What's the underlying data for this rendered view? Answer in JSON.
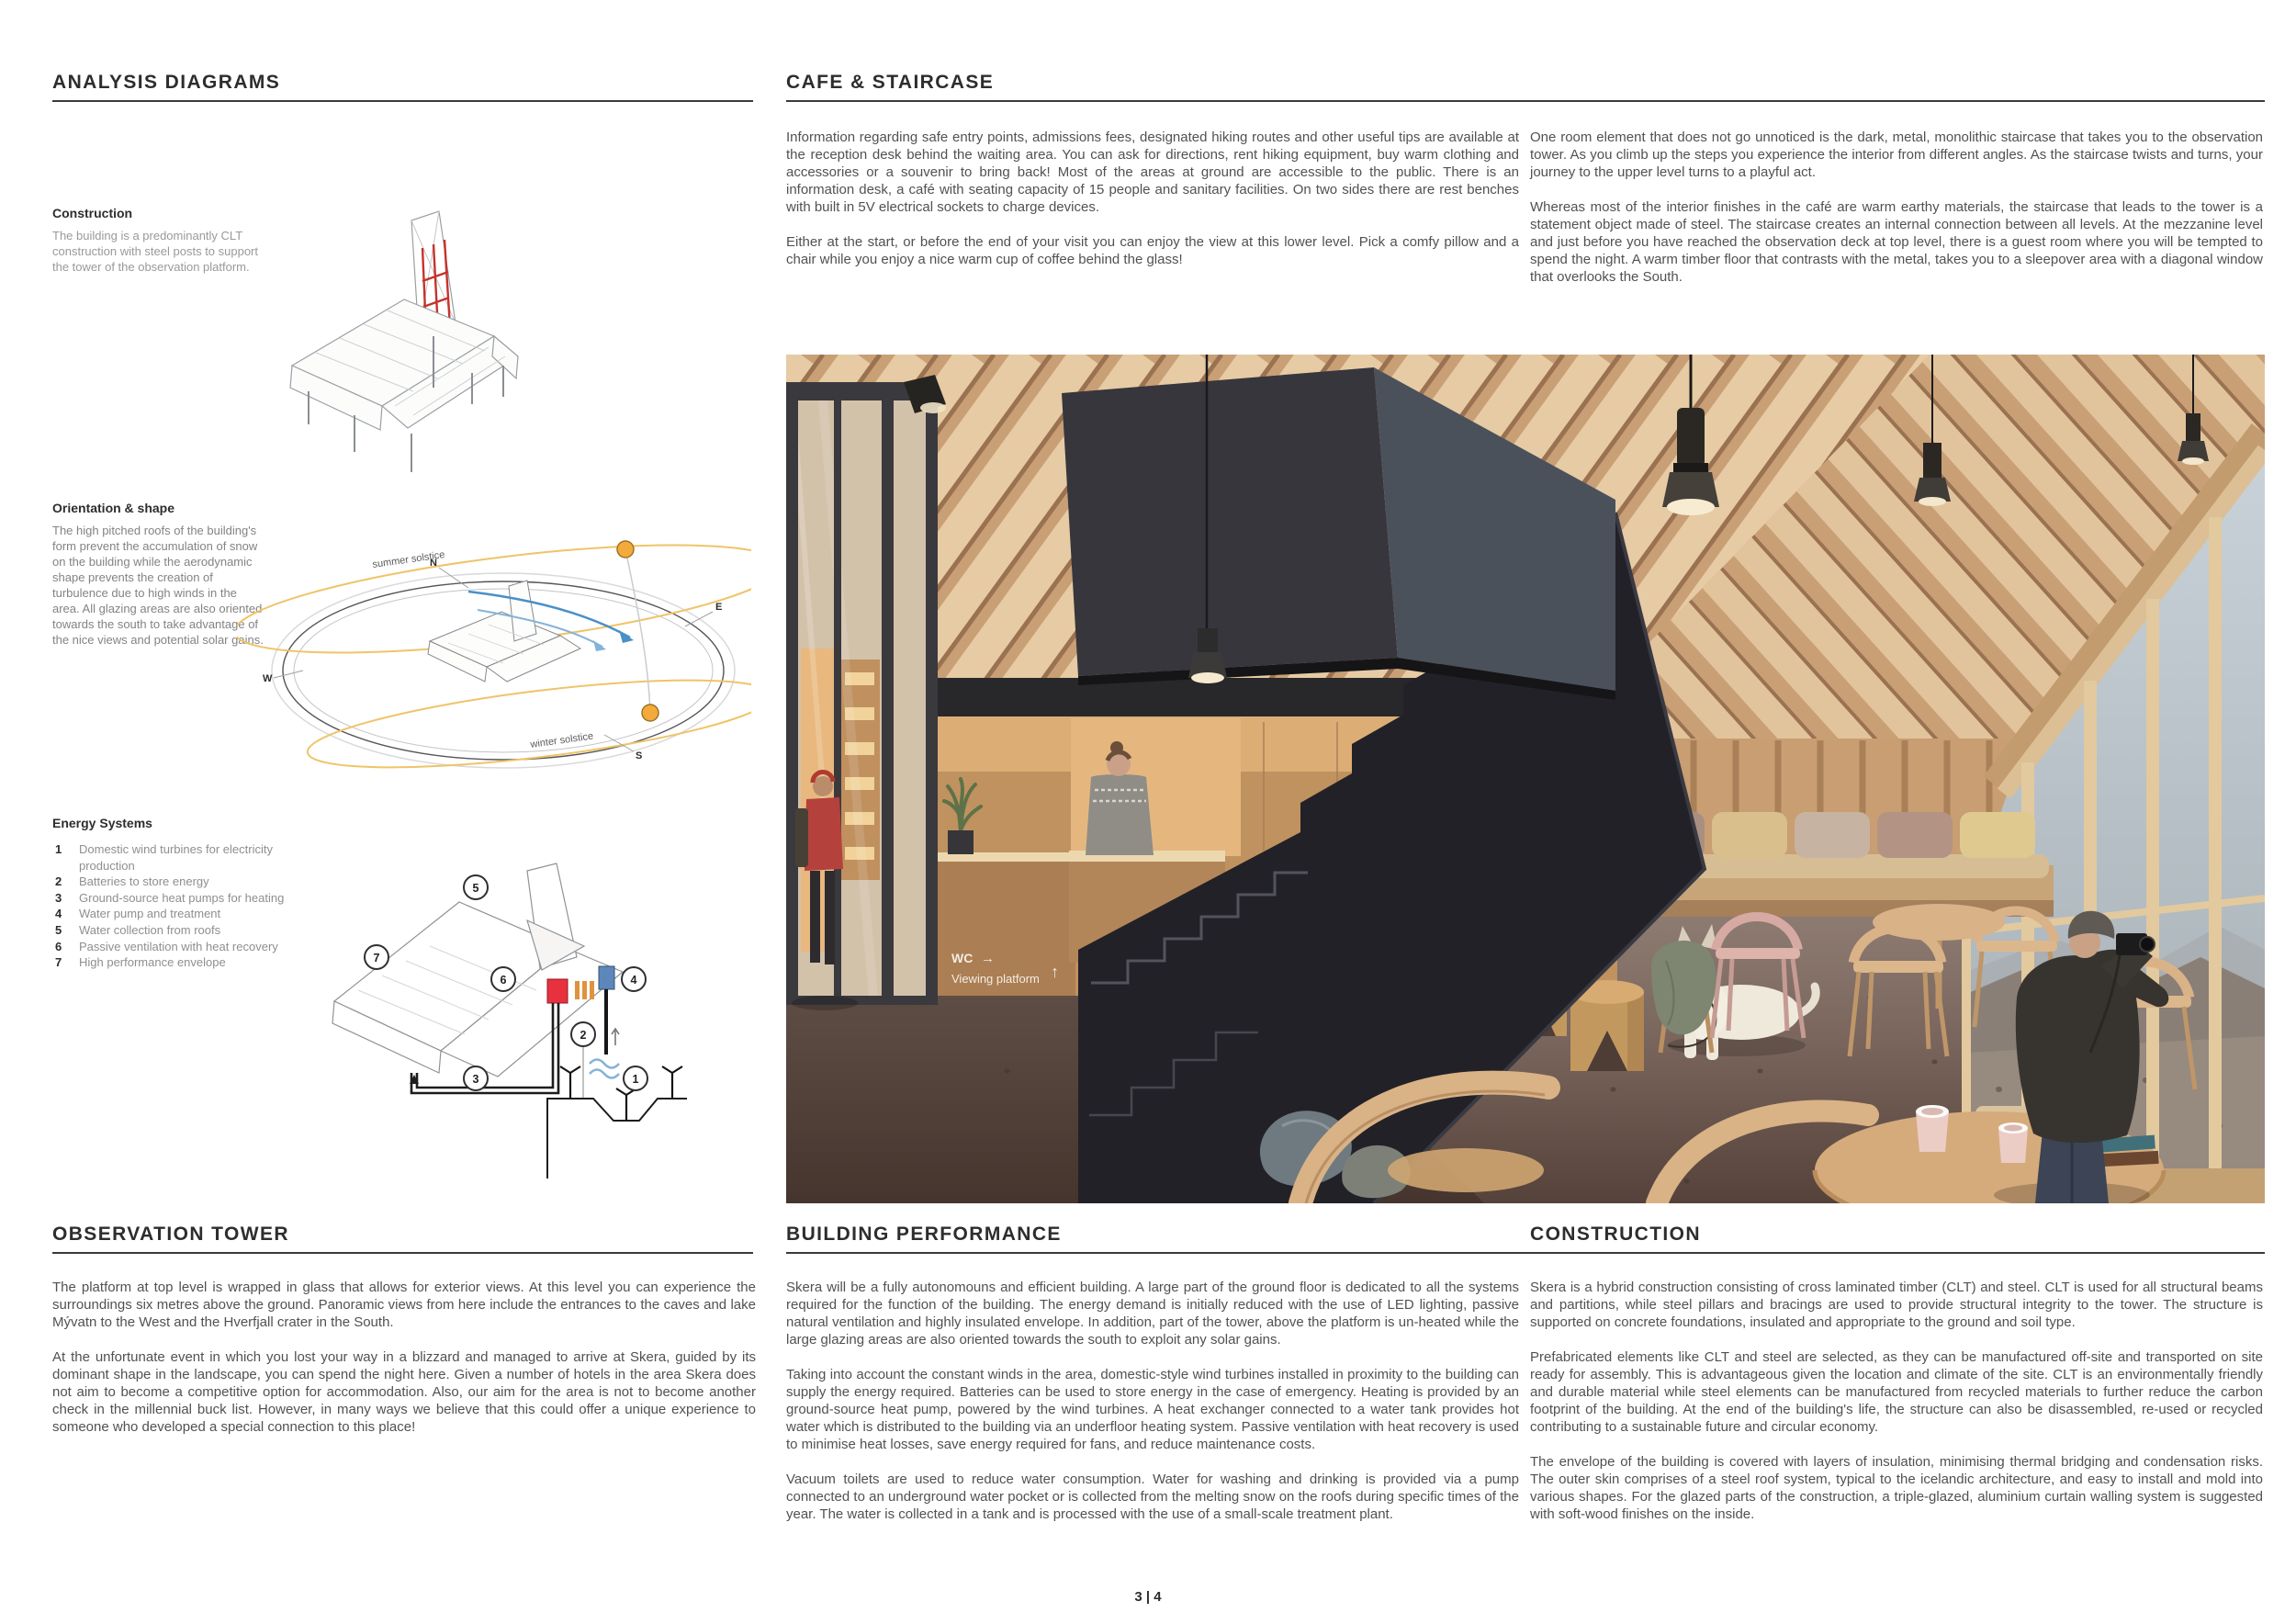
{
  "analysis": {
    "title": "ANALYSIS DIAGRAMS",
    "construction": {
      "heading": "Construction",
      "body": "The building is a predominantly CLT construction with steel posts to support the tower of the observation platform."
    },
    "orientation": {
      "heading": "Orientation & shape",
      "body": "The high pitched roofs of the building's form prevent the accumulation of snow on the building while the aerodynamic shape prevents the creation of turbulence due to high winds in the area. All glazing areas are also oriented towards the south to take advantage of the nice views and potential solar gains.",
      "labels": {
        "north": "N",
        "east": "E",
        "south": "S",
        "west": "W",
        "summer": "summer solstice",
        "winter": "winter solstice"
      }
    },
    "energy": {
      "heading": "Energy Systems",
      "items": [
        {
          "num": "1",
          "label": "Domestic wind turbines for electricity production"
        },
        {
          "num": "2",
          "label": "Batteries to store energy"
        },
        {
          "num": "3",
          "label": "Ground-source heat pumps for heating"
        },
        {
          "num": "4",
          "label": "Water pump and treatment"
        },
        {
          "num": "5",
          "label": "Water collection from roofs"
        },
        {
          "num": "6",
          "label": "Passive ventilation with heat recovery"
        },
        {
          "num": "7",
          "label": "High performance envelope"
        }
      ]
    }
  },
  "cafe": {
    "title": "CAFE & STAIRCASE",
    "col1": [
      "Information regarding safe entry points, admissions fees, designated hiking routes and other useful tips are available at the reception desk behind the waiting area. You can ask for directions, rent hiking equipment, buy warm clothing and accessories or a souvenir to bring back! Most of the areas at ground are accessible to the public. There is an information desk, a café with seating capacity of 15 people and sanitary facilities. On two sides there are rest benches with built in 5V electrical sockets to charge devices.",
      "Either at the start, or before the end of your visit you can enjoy the view at this lower level. Pick a comfy pillow and a chair while you enjoy a nice warm cup of coffee behind the glass!"
    ],
    "col2": [
      "One room element that does not go unnoticed is the dark, metal, monolithic staircase that takes you to the observation tower. As you climb up the steps you experience the interior from different angles. As the staircase twists and turns, your journey to the upper level turns to a playful act.",
      "Whereas most of the interior finishes in the café are warm earthy materials, the staircase that leads to the tower is a statement object made of steel. The staircase creates an internal connection between all levels. At the mezzanine level and just before you have reached the observation deck at top level, there is a guest room where you will be tempted to spend the night. A warm timber floor that contrasts with the metal, takes you to a sleepover area with a diagonal window that overlooks the South."
    ],
    "render": {
      "wc": "WC",
      "wc_arrow": "→",
      "viewing": "Viewing platform",
      "up_arrow": "↑"
    }
  },
  "observation": {
    "title": "OBSERVATION TOWER",
    "paragraphs": [
      "The platform at top level is wrapped in glass that allows for exterior views. At this level you can experience the surroundings six metres above the ground. Panoramic views from here include the entrances to the caves and lake Mývatn to the West and the Hverfjall crater in the South.",
      "At the unfortunate event in which you lost your way in a blizzard and managed to arrive at Skera, guided by its dominant shape in the landscape, you can spend the night here. Given a number of hotels in the area Skera does not aim to become a competitive option for accommodation. Also, our aim for the area is not to become another check in the millennial buck list. However, in many ways we believe that this could offer a unique experience to someone who developed a special connection to this place!"
    ]
  },
  "performance": {
    "title": "BUILDING PERFORMANCE",
    "paragraphs": [
      "Skera will be a fully autonomouns and efficient building. A large part of the ground floor is dedicated to all the systems required for the function of the building. The energy demand is initially reduced with the use of LED lighting, passive natural ventilation and highly insulated envelope. In addition, part of the tower, above the platform is un-heated while the large glazing areas are also oriented towards the south to exploit any solar gains.",
      "Taking into account the constant winds in the area, domestic-style wind turbines installed in proximity to the building can supply the energy required. Batteries can be used to store energy in the case of emergency. Heating is provided by an ground-source heat pump, powered by the wind turbines. A heat exchanger connected to a water tank provides hot water which is distributed to the building via an underfloor heating system. Passive ventilation with heat recovery is used to minimise heat losses, save energy required for fans, and reduce maintenance costs.",
      "Vacuum toilets are used to reduce water consumption. Water for washing and drinking is provided via a pump connected to an underground water pocket or is collected from the melting snow on the roofs during specific times of the year. The water is collected in a tank and is processed with the use of a small-scale treatment plant."
    ]
  },
  "construction_sec": {
    "title": "CONSTRUCTION",
    "paragraphs": [
      "Skera is a hybrid construction consisting of cross laminated timber (CLT) and steel. CLT is used for all structural beams and partitions, while steel pillars and bracings are used to provide structural integrity to the tower. The structure is supported on concrete foundations, insulated and appropriate to the ground and soil type.",
      "Prefabricated elements like CLT and steel are selected, as they can be manufactured off-site and transported on site ready for assembly. This is advantageous given the location and climate of the site. CLT is an environmentally friendly and durable material while steel elements can be manufactured from recycled materials to further reduce the carbon footprint of the building. At the end of the building's life, the structure can also be disassembled, re-used or recycled contributing to a sustainable future and circular economy.",
      "The envelope of the building is covered with layers of insulation, minimising thermal bridging and condensation risks. The outer skin comprises of a steel roof system, typical to the icelandic architecture, and easy to install and mold into various shapes. For the glazed parts of the construction, a triple-glazed, aluminium curtain walling system is suggested with soft-wood finishes on the inside."
    ]
  },
  "footer": {
    "page": "3 | 4"
  },
  "colors": {
    "accent_steel_red": "#c5332b",
    "solstice_yellow": "#efc468",
    "wind_arrow_blue": "#4a8fc7",
    "heat_pump_red": "#e8313f",
    "water_tank_blue": "#5d87bb",
    "radiator_orange": "#e0923f",
    "staircase_dark": "#222127",
    "timber_light": "#d8b68e"
  }
}
